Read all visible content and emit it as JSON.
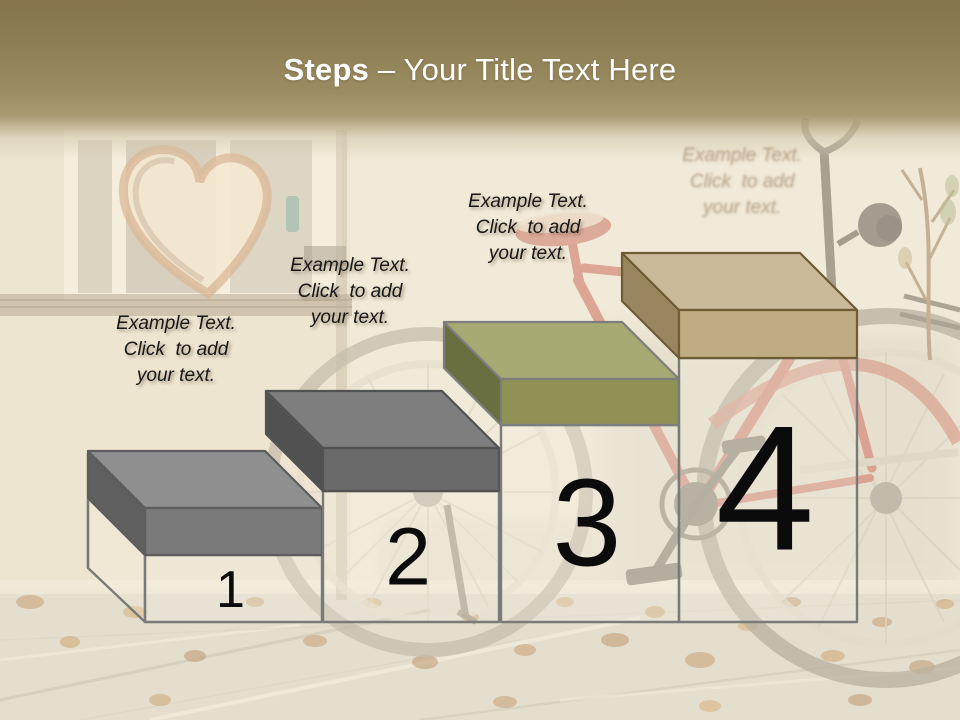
{
  "slide": {
    "title": {
      "bold": "Steps",
      "rest": " – Your Title Text Here"
    },
    "header": {
      "gradient_top": "#857549",
      "gradient_mid": "#9c8c62"
    },
    "box_style": {
      "body_outline": "#7a7a78",
      "body_fill": "#f7f2e6"
    },
    "steps": [
      {
        "number": "1",
        "label": "Example Text.\nClick  to add\nyour text.",
        "faded": false,
        "colors": {
          "top": "#8f8f8f",
          "front": "#7a7a7a",
          "side": "#5f5f5f",
          "outline": "#5d5d5d"
        }
      },
      {
        "number": "2",
        "label": "Example Text.\nClick  to add\nyour text.",
        "faded": false,
        "colors": {
          "top": "#7e7e7e",
          "front": "#6a6a6a",
          "side": "#515151",
          "outline": "#525252"
        }
      },
      {
        "number": "3",
        "label": "Example Text.\nClick  to add\nyour text.",
        "faded": false,
        "colors": {
          "top": "#a7a973",
          "front": "#8f9254",
          "side": "#6b6e3e",
          "outline": "#7d7d7d"
        }
      },
      {
        "number": "4",
        "label": "Example Text.\nClick  to add\nyour text.",
        "faded": true,
        "colors": {
          "top": "#cbba9a",
          "front": "#c0ac82",
          "side": "#9a865e",
          "outline": "#6e5c36"
        }
      }
    ]
  }
}
